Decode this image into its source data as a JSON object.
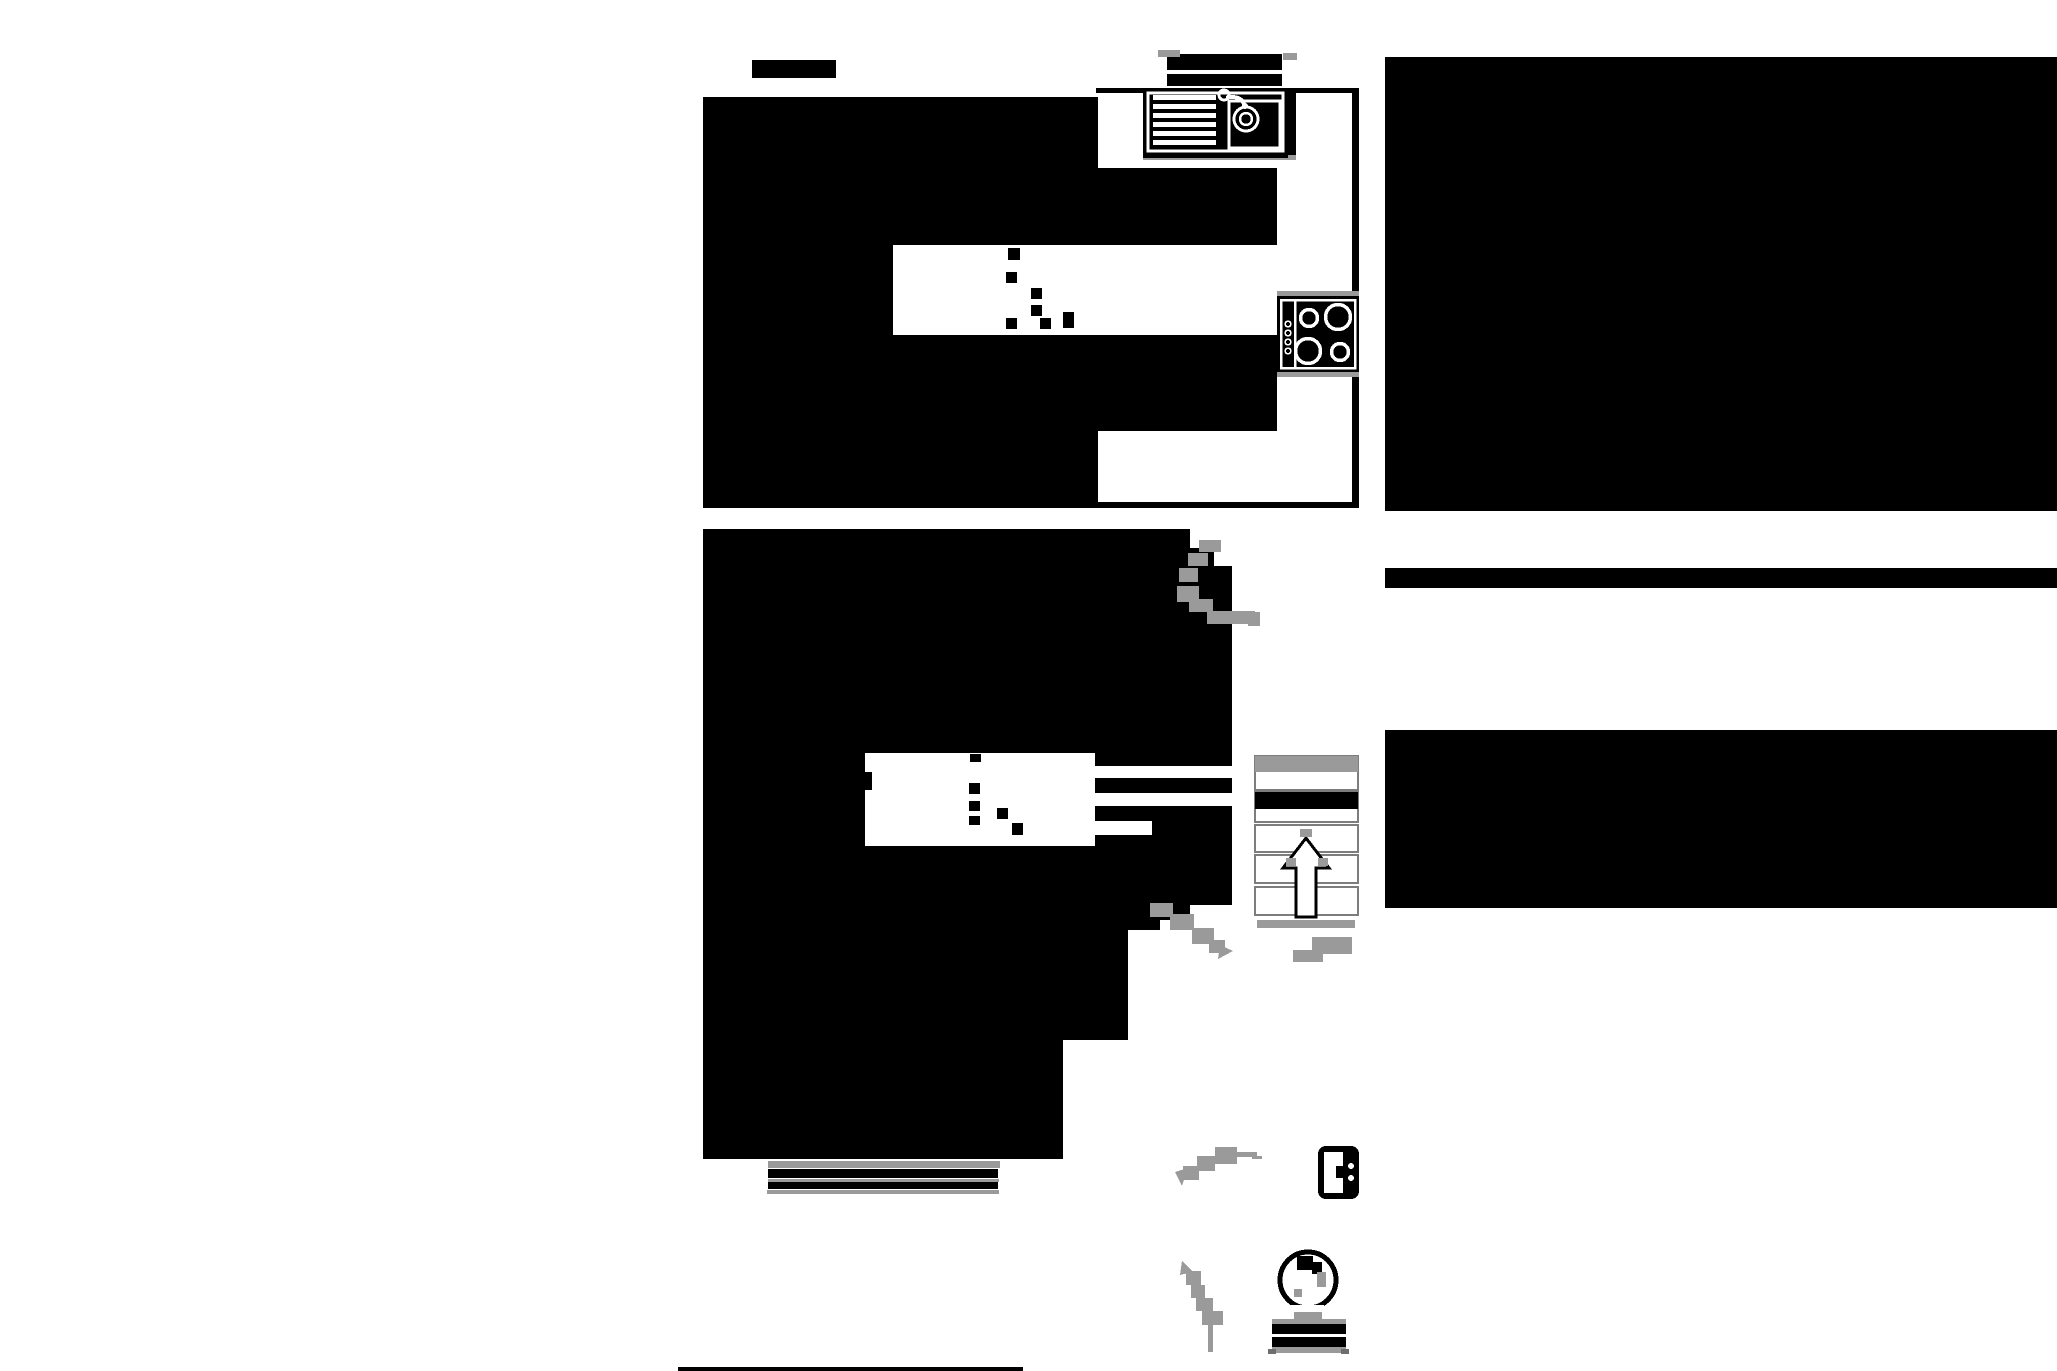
{
  "canvas": {
    "w": 2057,
    "h": 1371,
    "background": "#ffffff"
  },
  "palette": {
    "ink": "#000000",
    "paper": "#ffffff",
    "gray": "#9a9a9a",
    "grayLight": "#bdbdbd",
    "grayDark": "#6e6e6e"
  },
  "note": "Binarized floor-plan scan; room labels are degraded into illegible white marks; no legible text is present",
  "legible_text": [],
  "label_bar": [
    [
      752,
      60,
      84,
      18
    ]
  ],
  "scale_bar": [
    [
      678,
      1367,
      345,
      4
    ]
  ],
  "neighbor_blocks": [
    [
      1385,
      57,
      672,
      454
    ],
    [
      1385,
      568,
      672,
      20
    ],
    [
      1385,
      730,
      672,
      178
    ]
  ],
  "upper_room": [
    [
      703,
      97,
      395,
      148
    ],
    [
      703,
      245,
      190,
      90
    ],
    [
      703,
      335,
      395,
      173
    ],
    [
      1098,
      168,
      179,
      77
    ],
    [
      1098,
      335,
      179,
      96
    ]
  ],
  "lower_room": [
    [
      703,
      529,
      360,
      630
    ],
    [
      1063,
      529,
      65,
      511
    ],
    [
      1128,
      529,
      32,
      401
    ],
    [
      1160,
      529,
      30,
      391
    ],
    [
      1190,
      548,
      24,
      357
    ],
    [
      1214,
      566,
      18,
      339
    ]
  ],
  "kitchen_walls": [
    [
      1096,
      88,
      262,
      5
    ],
    [
      1352,
      88,
      7,
      420
    ],
    [
      1098,
      502,
      261,
      6
    ],
    [
      1288,
      88,
      8,
      72
    ]
  ],
  "window_bands": [
    [
      1167,
      54,
      115,
      16
    ],
    [
      1167,
      74,
      115,
      12
    ],
    [
      1158,
      50,
      22,
      7,
      "gray"
    ],
    [
      1283,
      53,
      14,
      7,
      "gray"
    ],
    [
      1143,
      155,
      153,
      5,
      "gray"
    ]
  ],
  "holes": [
    [
      865,
      753,
      230,
      93
    ],
    [
      1095,
      766,
      137,
      12
    ],
    [
      1095,
      793,
      137,
      13
    ],
    [
      1040,
      821,
      112,
      14
    ]
  ],
  "specks": [
    [
      1008,
      248,
      12,
      12
    ],
    [
      1006,
      272,
      11,
      11
    ],
    [
      1031,
      288,
      11,
      11
    ],
    [
      1031,
      305,
      11,
      11
    ],
    [
      1006,
      318,
      11,
      11
    ],
    [
      1040,
      318,
      11,
      11
    ],
    [
      1063,
      312,
      11,
      16
    ],
    [
      970,
      754,
      11,
      8
    ],
    [
      969,
      783,
      11,
      11
    ],
    [
      969,
      801,
      11,
      10
    ],
    [
      997,
      808,
      11,
      11
    ],
    [
      969,
      816,
      11,
      9
    ],
    [
      1012,
      823,
      11,
      12
    ],
    [
      865,
      772,
      7,
      18
    ]
  ],
  "bay_bands": [
    [
      768,
      1161,
      232,
      7,
      "gray"
    ],
    [
      768,
      1169,
      230,
      9,
      "ink"
    ],
    [
      768,
      1179,
      231,
      3,
      "gray"
    ],
    [
      768,
      1182,
      230,
      7,
      "ink"
    ],
    [
      767,
      1190,
      232,
      4,
      "gray"
    ]
  ],
  "stairs": {
    "treads": [
      {
        "r": [
          1255,
          756,
          103,
          34
        ],
        "band": [
          1255,
          756,
          103,
          16,
          "gray"
        ]
      },
      {
        "r": [
          1255,
          792,
          103,
          30
        ],
        "band": [
          1255,
          792,
          103,
          17,
          "ink"
        ]
      },
      {
        "r": [
          1255,
          825,
          103,
          27
        ]
      },
      {
        "r": [
          1255,
          855,
          43,
          28
        ]
      },
      {
        "r": [
          1313,
          855,
          45,
          28
        ]
      },
      {
        "r": [
          1255,
          887,
          43,
          28
        ]
      },
      {
        "r": [
          1313,
          887,
          45,
          28
        ]
      }
    ],
    "base_bar": [
      [
        1257,
        920,
        98,
        8,
        "gray"
      ]
    ],
    "landing": [
      [
        1312,
        937,
        40,
        17,
        "gray"
      ],
      [
        1293,
        950,
        30,
        12,
        "gray"
      ]
    ],
    "arrow_points": "1306,838 1329,868 1316,868 1316,917 1296,917 1296,868 1283,868",
    "arrow_specks": [
      [
        1300,
        829,
        12,
        8,
        "gray"
      ],
      [
        1286,
        858,
        10,
        8,
        "gray"
      ],
      [
        1318,
        858,
        10,
        8,
        "gray"
      ]
    ]
  },
  "zigzags": [
    {
      "steps": [
        [
          1199,
          540,
          22,
          12
        ],
        [
          1188,
          553,
          20,
          13
        ],
        [
          1179,
          568,
          19,
          14
        ],
        [
          1177,
          586,
          22,
          16
        ],
        [
          1189,
          599,
          24,
          13
        ],
        [
          1207,
          611,
          48,
          13
        ],
        [
          1248,
          612,
          12,
          14
        ]
      ]
    },
    {
      "steps": [
        [
          1150,
          903,
          23,
          14
        ],
        [
          1170,
          914,
          24,
          16
        ],
        [
          1192,
          928,
          22,
          16
        ],
        [
          1209,
          940,
          16,
          13
        ]
      ],
      "tip": "1220,945 1233,951 1218,959"
    },
    {
      "steps": [
        [
          1183,
          1166,
          16,
          14
        ],
        [
          1197,
          1156,
          18,
          15
        ],
        [
          1215,
          1147,
          22,
          17
        ],
        [
          1235,
          1152,
          22,
          5
        ],
        [
          1252,
          1156,
          10,
          3
        ]
      ],
      "tip": "1175,1172 1188,1168 1182,1186"
    },
    {
      "steps": [
        [
          1186,
          1271,
          15,
          14
        ],
        [
          1191,
          1285,
          14,
          13
        ],
        [
          1196,
          1298,
          17,
          13
        ],
        [
          1202,
          1311,
          21,
          14
        ],
        [
          1208,
          1325,
          5,
          27
        ]
      ],
      "tip": "1182,1261 1193,1272 1180,1275"
    }
  ],
  "sink": {
    "body": [
      1143,
      88,
      145,
      70
    ],
    "inner": [
      1148,
      93,
      135,
      58
    ],
    "drainer": {
      "x": 1153,
      "y0": 95,
      "w": 63,
      "h": 5,
      "gap": 9,
      "count": 6
    },
    "basin": [
      1229,
      101,
      51,
      47
    ],
    "drain": {
      "cx": 1246,
      "cy": 119,
      "r": 12,
      "r2": 6
    },
    "faucet": {
      "ring": {
        "cx": 1224,
        "cy": 95,
        "r": 5
      },
      "spout": "M 1228 97 Q 1241 96 1244 104",
      "tip": {
        "cx": 1245,
        "cy": 106,
        "r": 3
      }
    }
  },
  "stove": {
    "body": [
      1277,
      296,
      82,
      76
    ],
    "caps": [
      [
        1277,
        291,
        82,
        5,
        "gray"
      ],
      [
        1277,
        372,
        82,
        5,
        "gray"
      ]
    ],
    "inner": [
      1281,
      300,
      74,
      68
    ],
    "divider": {
      "x1": 1295,
      "y1": 300,
      "x2": 1295,
      "y2": 368
    },
    "dots": [
      {
        "cx": 1288,
        "cy": 324,
        "r": 2.8
      },
      {
        "cx": 1288,
        "cy": 333,
        "r": 2.8
      },
      {
        "cx": 1288,
        "cy": 342,
        "r": 2.8
      },
      {
        "cx": 1288,
        "cy": 351,
        "r": 2.8
      }
    ],
    "burners": [
      {
        "cx": 1309,
        "cy": 318,
        "r": 8.5
      },
      {
        "cx": 1338,
        "cy": 317,
        "r": 12.5
      },
      {
        "cx": 1308,
        "cy": 351,
        "r": 12.5
      },
      {
        "cx": 1340,
        "cy": 352,
        "r": 8.5
      }
    ]
  },
  "door": {
    "frame": [
      1318,
      1146,
      41,
      53
    ],
    "frame_radius": 8,
    "slab": [
      1324,
      1152,
      19,
      41
    ],
    "latch": [
      1336,
      1166,
      11,
      12
    ],
    "hinges": [
      {
        "cx": 1351,
        "cy": 1166,
        "r": 3
      },
      {
        "cx": 1351,
        "cy": 1178,
        "r": 3
      }
    ]
  },
  "toilet": {
    "bowl": {
      "cx": 1308,
      "cy": 1280,
      "r": 28,
      "stroke": 5
    },
    "marks": [
      [
        1297,
        1256,
        16,
        14,
        "ink"
      ],
      [
        1312,
        1262,
        10,
        12,
        "ink"
      ],
      [
        1317,
        1272,
        9,
        15,
        "gray"
      ],
      [
        1294,
        1289,
        8,
        8,
        "gray"
      ]
    ],
    "neck": [
      [
        1291,
        1305,
        33,
        16,
        "paper"
      ],
      [
        1294,
        1312,
        28,
        8,
        "gray"
      ]
    ],
    "tank": [
      [
        1272,
        1319,
        74,
        34,
        "paper"
      ],
      [
        1272,
        1319,
        74,
        5,
        "gray"
      ],
      [
        1272,
        1324,
        74,
        10,
        "ink"
      ],
      [
        1272,
        1337,
        74,
        10,
        "ink"
      ],
      [
        1272,
        1347,
        74,
        6,
        "gray"
      ],
      [
        1268,
        1349,
        8,
        5,
        "grayDark"
      ],
      [
        1341,
        1349,
        8,
        5,
        "grayDark"
      ]
    ]
  }
}
